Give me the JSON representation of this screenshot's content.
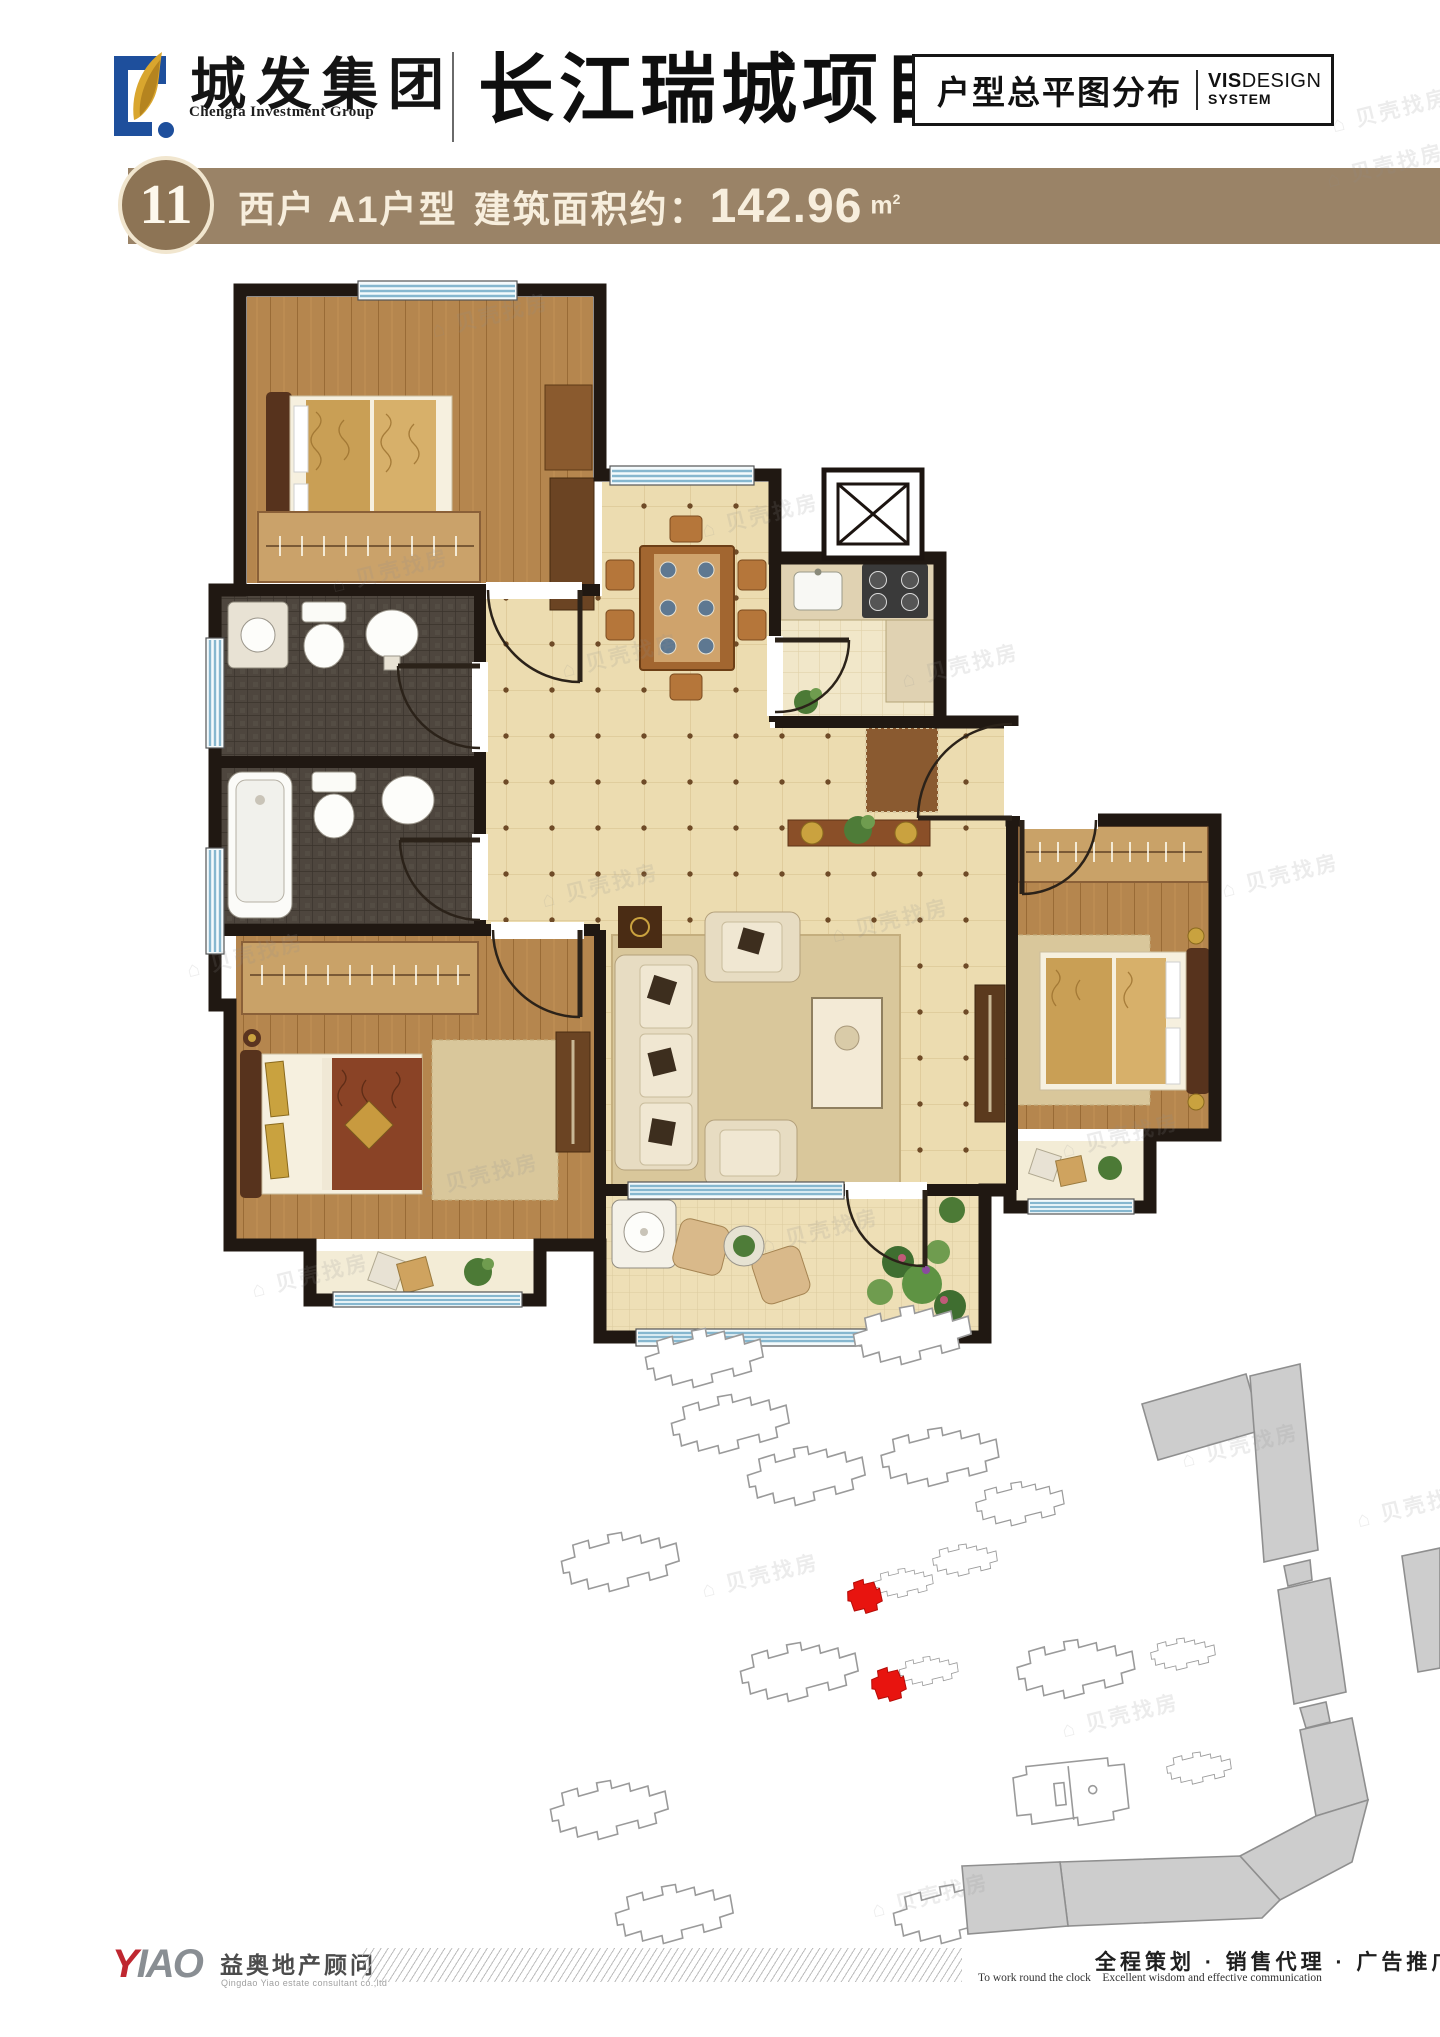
{
  "header": {
    "logo_cn": "城发集团",
    "logo_en": "Chengfa Investment Group",
    "logo_icon": "chengfa-c-leaf-logo",
    "project_title": "长江瑞城项目",
    "box_label": "户型总平图分布",
    "vis_bold": "VIS",
    "vis_rest": "DESIGN",
    "vis_line2": "SYSTEM"
  },
  "banner": {
    "number": "11",
    "unit_type": "西户 A1户型",
    "area_label": "建筑面积约：",
    "area_value": "142.96",
    "area_unit": "m",
    "area_sup": "2",
    "bg_color": "#9a8367",
    "badge_color": "#8d7455",
    "text_color": "#f7eedd"
  },
  "floor_plan": {
    "wall_color": "#201812",
    "window_color": "#86b7cf",
    "wood_color": "#b5864e",
    "tile_color": "#ecdcb0",
    "mosaic_color": "#4e463e",
    "rooms": [
      "bedroom-top-left",
      "bathroom-upper",
      "bathroom-lower",
      "dining-room",
      "kitchen",
      "hallway",
      "living-room",
      "bedroom-bottom-left",
      "bedroom-right",
      "balcony",
      "elevator-shaft"
    ]
  },
  "site_plan": {
    "outline_buildings": 17,
    "highlighted_buildings": 2,
    "highlight_color": "#e8140f",
    "building_outline": "#9a9a9a",
    "building_fill": "#ffffff",
    "gray_fill": "#cdcdcd"
  },
  "watermark": {
    "text": "贝壳找房"
  },
  "footer": {
    "logo_part1": "Y",
    "logo_part2": "IAO",
    "agency_name": "益奥地产顾问",
    "agency_sub": "Qingdao Yiao estate consultant co.,ltd",
    "services_cn": "全程策划 · 销售代理 · 广告推广",
    "services_en": "To work round the clock    Excellent wisdom and effective communication"
  }
}
